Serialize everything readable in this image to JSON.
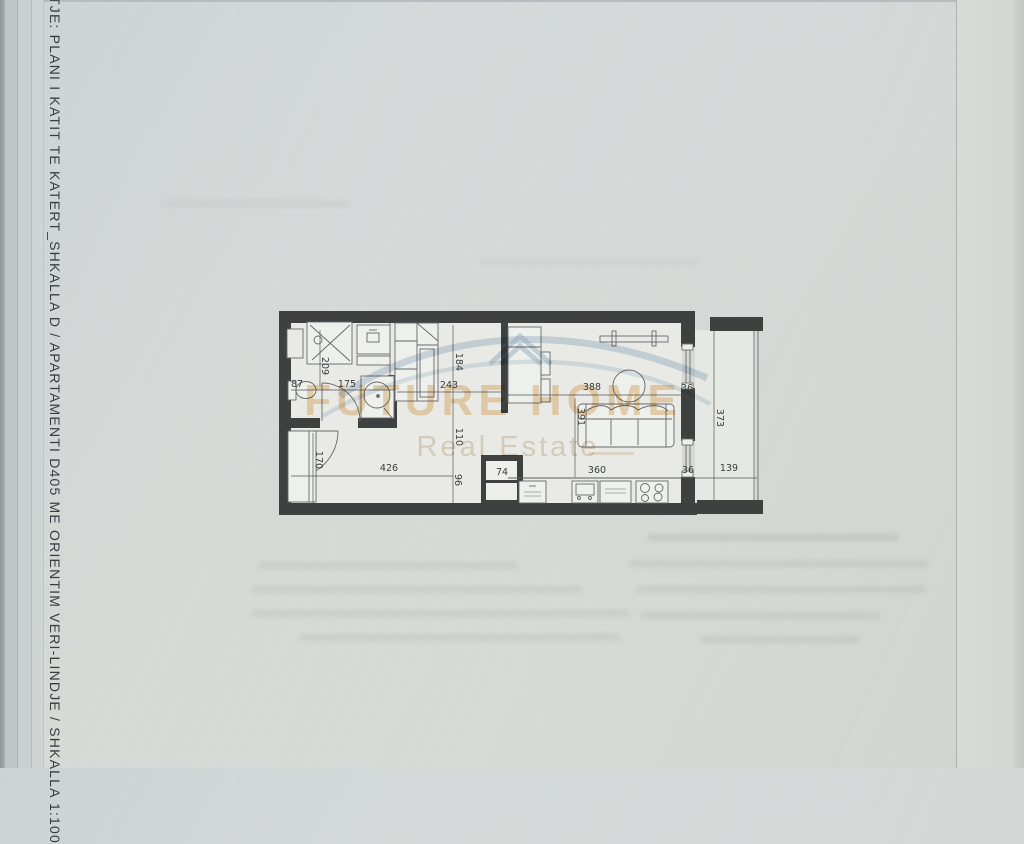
{
  "page": {
    "side_title": "TJE: PLANI I KATIT TE KATERT_SHKALLA D / APARTAMENTI D405 ME ORIENTIM VERI-LINDJE / SHKALLA 1:100"
  },
  "watermark": {
    "brand": "FUTURE HOME",
    "tagline": "Real Estate",
    "brand_color": "#dea04a",
    "swoosh_color": "#a9c2d4"
  },
  "plan": {
    "wall_color": "#3f4040",
    "floor_color": "#e9eae6",
    "dims": {
      "d209": "209",
      "d87": "87",
      "d175": "175",
      "d184": "184",
      "d243": "243",
      "d110": "110",
      "d96": "96",
      "d170": "170",
      "d426": "426",
      "d74": "74",
      "d388": "388",
      "d391": "391",
      "d360": "360",
      "d36a": "36",
      "d36b": "36",
      "d373": "373",
      "d139": "139"
    }
  }
}
